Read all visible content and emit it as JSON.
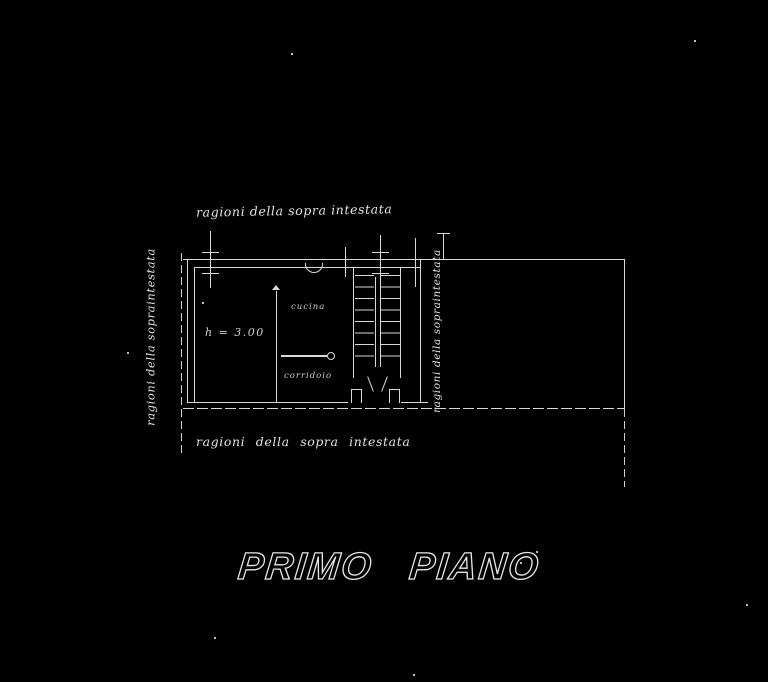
{
  "drawing": {
    "floor_title": "PRIMO PIANO",
    "notes": {
      "top": "ragioni della sopra intestata",
      "bottom": "ragioni della  sopra intestata",
      "left": "ragioni della sopraintestata",
      "right": "ragioni della sopraintestata"
    },
    "rooms": {
      "main": {
        "label": "h = 3.00"
      },
      "kitchen": {
        "label": "cucina"
      },
      "corridor": {
        "label": "corridoio"
      }
    },
    "colors": {
      "background": "#000000",
      "ink": "#d9d9d9"
    }
  }
}
